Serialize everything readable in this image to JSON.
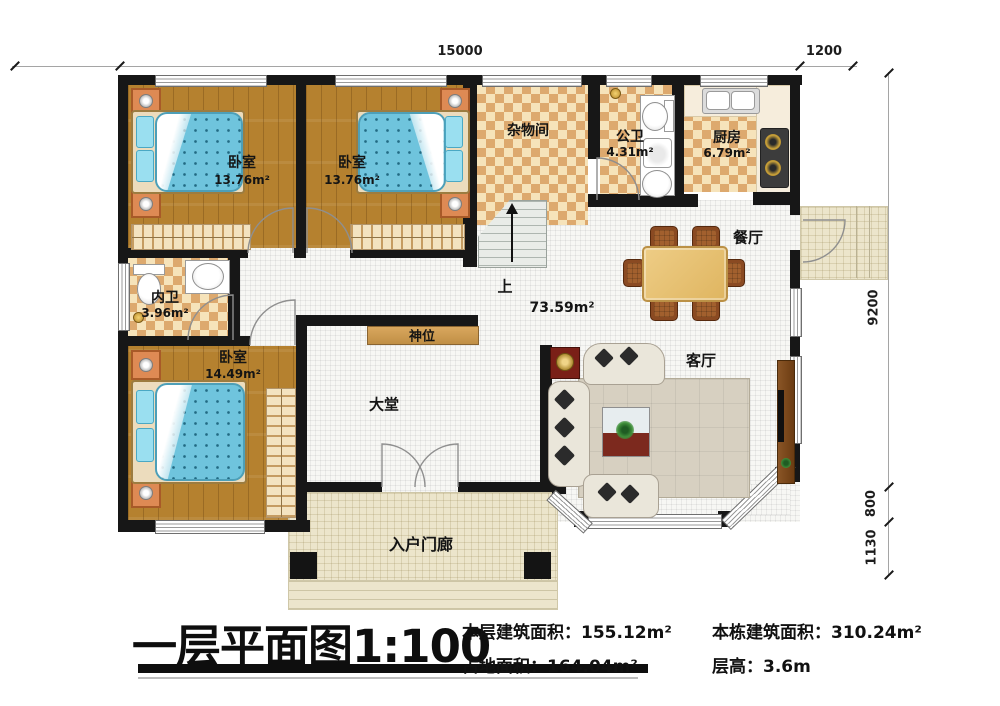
{
  "title": {
    "text": "一层平面图1:100"
  },
  "stats": [
    {
      "label": "本层建筑面积：",
      "value": "155.12m²"
    },
    {
      "label": "本栋建筑面积：",
      "value": "310.24m²"
    },
    {
      "label": "占地面积：",
      "value": "164.04m²"
    },
    {
      "label": "层高：",
      "value": "3.6m"
    }
  ],
  "rooms": {
    "bedroom1": {
      "name": "卧室",
      "area": "13.76m²"
    },
    "bedroom2": {
      "name": "卧室",
      "area": "13.76m²"
    },
    "bedroom3": {
      "name": "卧室",
      "area": "14.49m²"
    },
    "storage": {
      "name": "杂物间"
    },
    "public_bath": {
      "name": "公卫",
      "area": "4.31m²"
    },
    "kitchen": {
      "name": "厨房",
      "area": "6.79m²"
    },
    "inner_bath": {
      "name": "内卫",
      "area": "3.96m²"
    },
    "dining": {
      "name": "餐厅"
    },
    "living": {
      "name": "客厅"
    },
    "hall": {
      "name": "大堂"
    },
    "open_area": {
      "value": "73.59m²"
    },
    "shrine": {
      "name": "神位"
    },
    "porch": {
      "name": "入户门廊"
    },
    "stairs": {
      "up": "上"
    }
  },
  "dimensions": {
    "top_width": "15000",
    "top_side": "1200",
    "right_height": "9200",
    "right_mid": "800",
    "right_low": "1130"
  },
  "colors": {
    "wall": "#171717",
    "wood_floor": "#b5812f",
    "tile_dark": "#dda96e",
    "tile_light": "#f6e3ba",
    "bed_blue": "#6fc4dd",
    "hall_floor": "#f7f7f4",
    "porch_floor": "#ece5cb",
    "shrine_shelf": "#d9a75e",
    "cabinet_red": "#7a2017",
    "table_wood": "#e9c478"
  }
}
